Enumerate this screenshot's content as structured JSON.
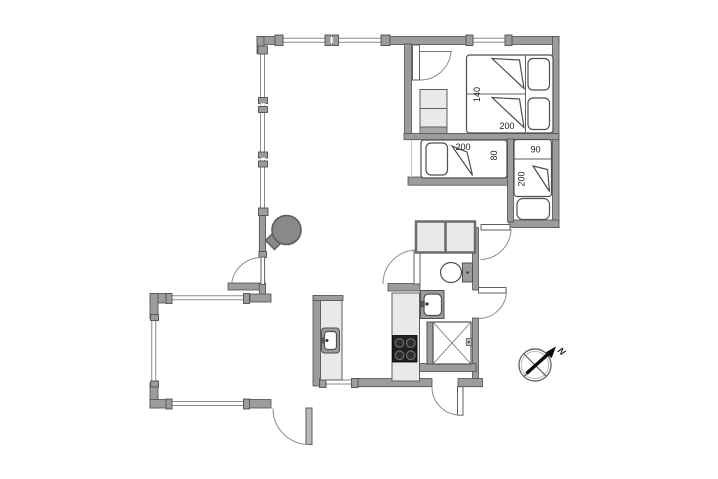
{
  "floorplan": {
    "kind": "holiday-home floor plan",
    "labels": {
      "double_bed_width": "140",
      "double_bed_length": "200",
      "alcove_bed_length": "200",
      "alcove_bed_width": "80",
      "annex_bed_width": "90",
      "annex_bed_length": "200"
    },
    "compass": {
      "north_label": "N"
    },
    "colors": {
      "wall": "#9c9c9c",
      "wall_outline": "#4f4f4f",
      "furniture_light": "#e9e9e9",
      "bed_fill": "#ffffff",
      "cooktop": "#202020",
      "stove": "#898989",
      "label_text": "#1b1b24",
      "background": "#ffffff"
    },
    "icons": [
      "double-bed-icon",
      "single-bed-icon",
      "wardrobe-icon",
      "wood-stove-icon",
      "toilet-icon",
      "washbasin-icon",
      "shower-icon",
      "kitchen-sink-icon",
      "cooktop-icon",
      "compass-rose-icon",
      "door-swing-icon",
      "window-icon"
    ]
  }
}
